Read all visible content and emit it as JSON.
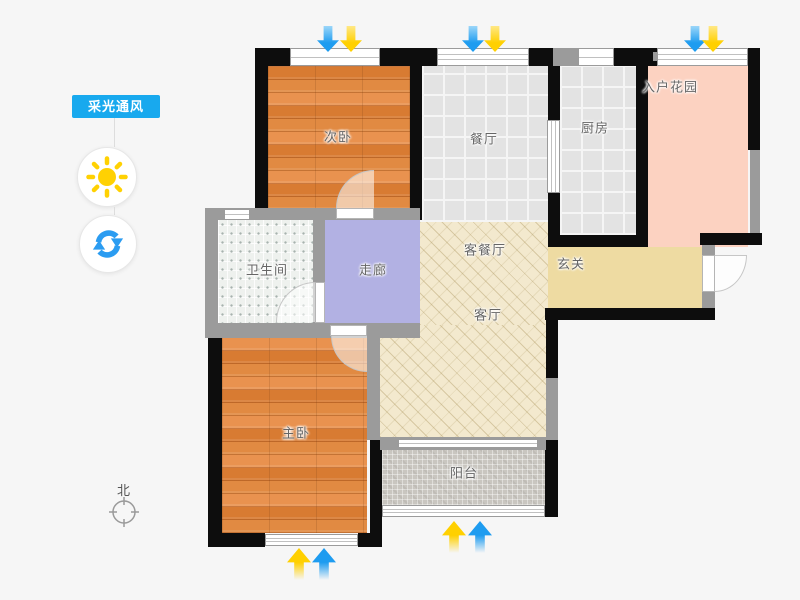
{
  "app": {
    "background": "#f6f6f6"
  },
  "tools": {
    "badge_label": "采光通风",
    "badge_color": "#18a9ee",
    "buttons": [
      {
        "id": "sunlight",
        "icon": "sun-icon",
        "color": "#ffd102"
      },
      {
        "id": "rotate",
        "icon": "refresh-icon",
        "color": "#2b9cf1"
      }
    ]
  },
  "compass": {
    "north_label": "北"
  },
  "floorplan": {
    "rooms": [
      {
        "id": "bedroom2",
        "label": "次卧",
        "floor": "wood"
      },
      {
        "id": "dining",
        "label": "餐厅",
        "floor": "tile"
      },
      {
        "id": "kitchen",
        "label": "厨房",
        "floor": "tile"
      },
      {
        "id": "entry-garden",
        "label": "入户花园",
        "floor": "pink"
      },
      {
        "id": "bathroom",
        "label": "卫生间",
        "floor": "dot-tile"
      },
      {
        "id": "corridor",
        "label": "走廊",
        "floor": "lavender"
      },
      {
        "id": "living-dining",
        "label": "客餐厅",
        "floor": "beige-hatch"
      },
      {
        "id": "hallway",
        "label": "玄关",
        "floor": "tan"
      },
      {
        "id": "living",
        "label": "客厅",
        "floor": "beige-hatch"
      },
      {
        "id": "master-bedroom",
        "label": "主卧",
        "floor": "wood"
      },
      {
        "id": "balcony",
        "label": "阳台",
        "floor": "mosaic"
      }
    ],
    "colors": {
      "wall_black": "#0d0d0d",
      "wall_gray": "#9b9b9b",
      "wood": "#e0833c",
      "tile": "#e3e3e3",
      "bath_tile": "#eef1ee",
      "corridor": "#b2b1e3",
      "living_beige": "#f3e9ce",
      "hall_tan": "#eedba2",
      "garden_pink": "#fcd2c1",
      "balcony_gray": "#c9c6c0",
      "arrow_blue": "#1e9cf0",
      "arrow_yellow": "#ffd000"
    },
    "airflow_arrows": [
      {
        "position": "top-bedroom2",
        "direction": "down",
        "order": [
          "blue",
          "yellow"
        ]
      },
      {
        "position": "top-dining",
        "direction": "down",
        "order": [
          "blue",
          "yellow"
        ]
      },
      {
        "position": "top-entry-garden",
        "direction": "down",
        "order": [
          "blue",
          "yellow"
        ]
      },
      {
        "position": "bottom-master-bedroom",
        "direction": "up",
        "order": [
          "yellow",
          "blue"
        ]
      },
      {
        "position": "bottom-balcony",
        "direction": "up",
        "order": [
          "yellow",
          "blue"
        ]
      }
    ]
  }
}
